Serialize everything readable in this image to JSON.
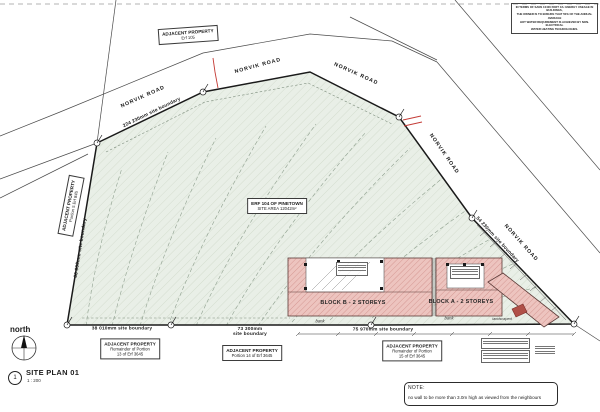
{
  "sheet": {
    "plan_number": "1",
    "plan_title": "SITE PLAN 01",
    "plan_scale": "1 : 200",
    "north_label": "north",
    "note": {
      "heading": "NOTE:",
      "body": "no wall to be more than 3.0m high as viewed from the neighbours"
    },
    "disclaimer_lines": {
      "l1": "IN TERMS OF SANS 10400 PART XA: ENERGY USEAGE IN BUILDINGS,",
      "l2": "THE OWNER IS TO ENSURE THAT 50% OF THE ANNUAL AVERAGE",
      "l3": "HOT WATER REQUIREMENT IS ACHIEVED BY NON-ELECTRICAL",
      "l4": "WATER HEATING TECHNOLOGIES."
    }
  },
  "roads": {
    "norvik": "NORVIK ROAD"
  },
  "site": {
    "erf_box": {
      "l1": "ERF 104 OF PINETOWN",
      "l2": "SITE AREA 12042m²"
    },
    "boundaries": {
      "top": "224 230mm site boundary",
      "left": "66 600mm site boundary",
      "right": "54 230mm site boundary",
      "bottom_left": "38 010mm site boundary",
      "bottom_mid_l1": "73 300mm",
      "bottom_mid_l2": "site boundary",
      "bottom_right": "75 970mm site boundary"
    },
    "annotations": {
      "bank": "bank",
      "landscaped": "landscaped"
    }
  },
  "adjacent": {
    "top": {
      "l1": "ADJACENT PROPERTY",
      "l2": "Erf 105"
    },
    "left": {
      "l1": "ADJACENT PROPERTY",
      "l2": "Portion 5 Erf 845"
    },
    "b13": {
      "l1": "ADJACENT PROPERTY",
      "l2": "Remainder of Portion",
      "l3": "13 of Erf 3645"
    },
    "b14": {
      "l1": "ADJACENT PROPERTY",
      "l2": "Portion 14 of Erf 3645"
    },
    "b15": {
      "l1": "ADJACENT PROPERTY",
      "l2": "Remainder of Portion",
      "l3": "15 of Erf 3645"
    }
  },
  "buildings": {
    "block_b": "BLOCK B - 2 STOREYS",
    "block_a": "BLOCK A - 2 STOREYS"
  },
  "colors": {
    "site_fill": "#e9efe7",
    "site_hatch": "#d4ddcf",
    "building_fill": "#edc4bf",
    "building_hatch": "#cf8d88",
    "accent_red": "#c43b36",
    "line": "#1a1a1a"
  }
}
